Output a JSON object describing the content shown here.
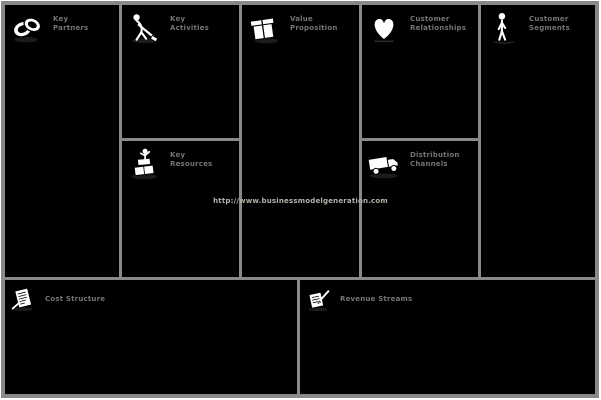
{
  "colors": {
    "page_background": "#ffffff",
    "cell_background": "#000000",
    "border": "#898989",
    "label_text": "#747474",
    "watermark_text": "#b3b3aa",
    "icon_fill": "#ffffff",
    "icon_outline": "#000000"
  },
  "watermark": "http://www.businessmodelgeneration.com",
  "blocks": [
    {
      "id": "key-partners",
      "icon": "rings-icon",
      "line1": "Key",
      "line2": "Partners"
    },
    {
      "id": "key-activities",
      "icon": "digging-person-icon",
      "line1": "Key",
      "line2": "Activities"
    },
    {
      "id": "value-proposition",
      "icon": "gift-icon",
      "line1": "Value",
      "line2": "Proposition"
    },
    {
      "id": "customer-relationships",
      "icon": "heart-icon",
      "line1": "Customer",
      "line2": "Relationships"
    },
    {
      "id": "customer-segments",
      "icon": "person-icon",
      "line1": "Customer",
      "line2": "Segments"
    },
    {
      "id": "key-resources",
      "icon": "blocks-figure-icon",
      "line1": "Key",
      "line2": "Resources"
    },
    {
      "id": "channels",
      "icon": "truck-icon",
      "line1": "Distribution",
      "line2": "Channels"
    },
    {
      "id": "cost-structure",
      "icon": "notepad-icon",
      "line1": "Cost Structure",
      "line2": ""
    },
    {
      "id": "revenue-streams",
      "icon": "writing-hand-icon",
      "line1": "Revenue Streams",
      "line2": ""
    }
  ]
}
